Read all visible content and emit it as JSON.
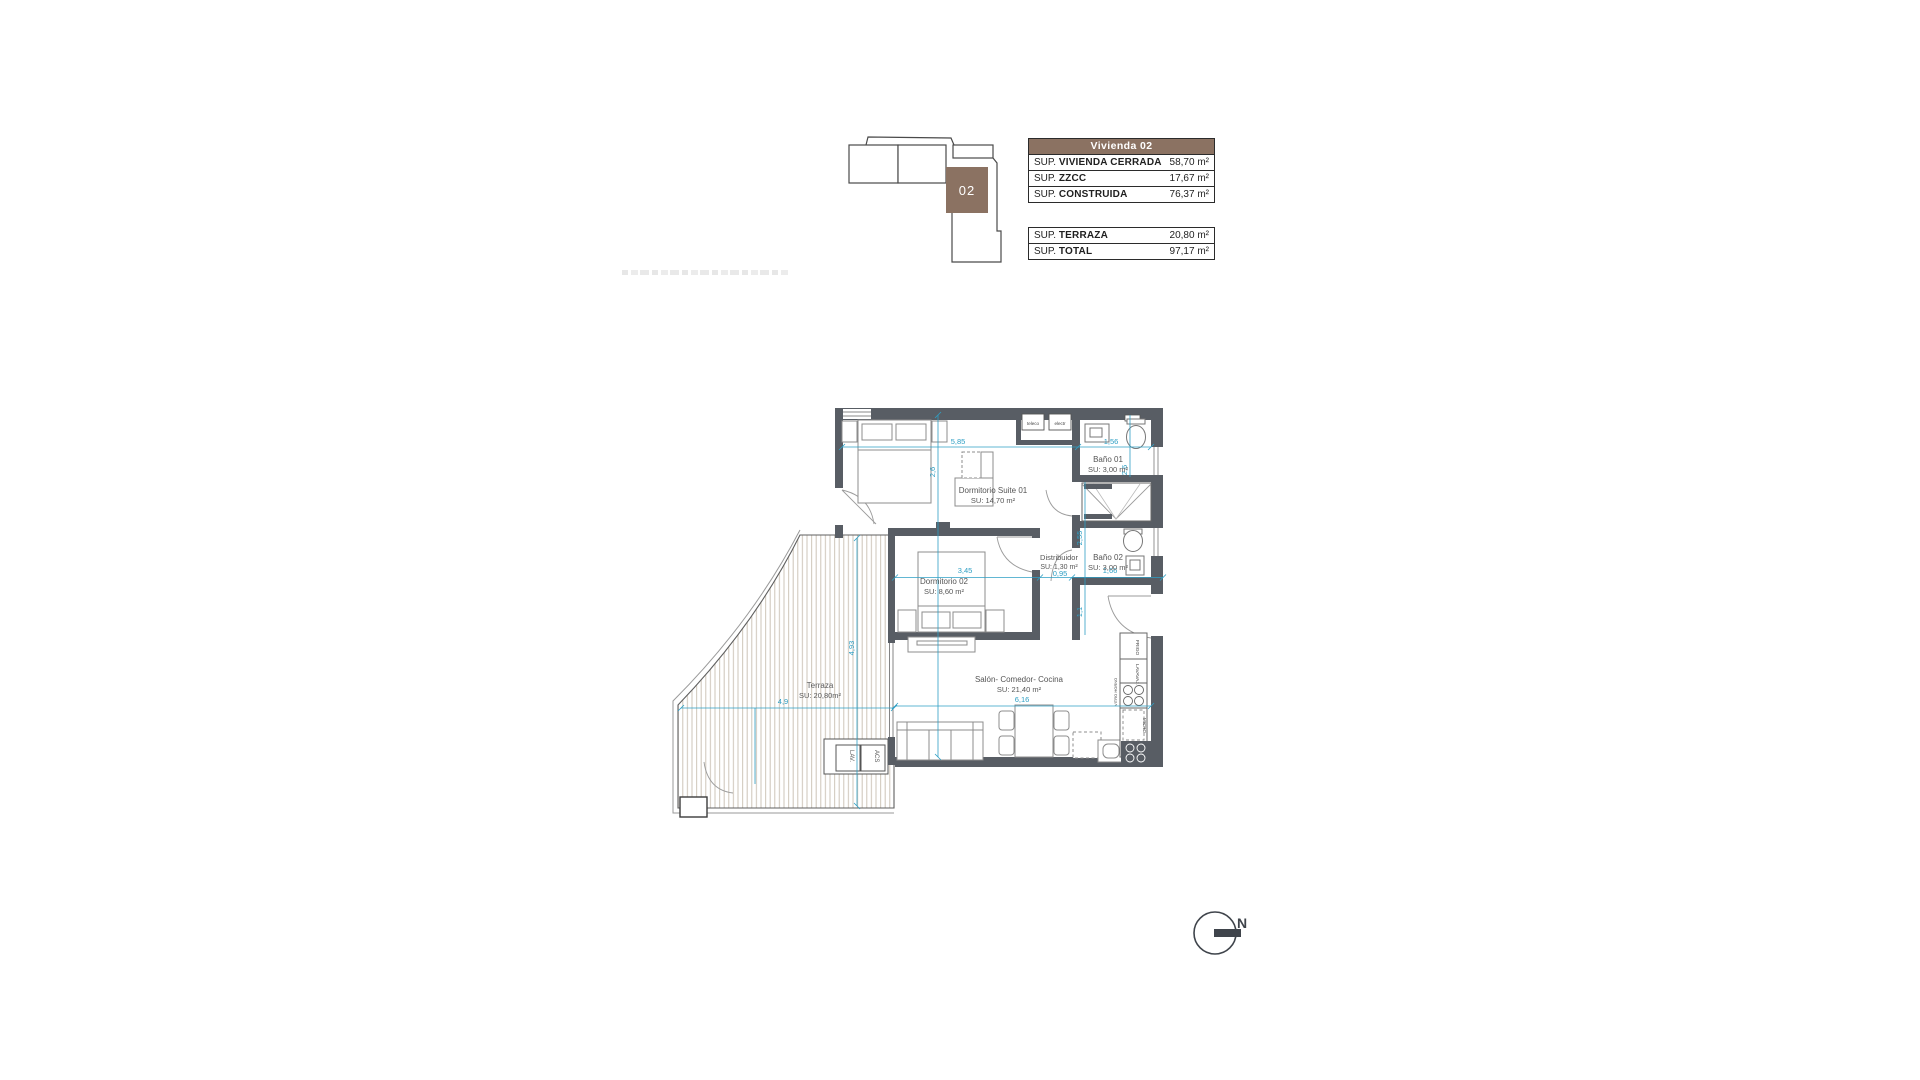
{
  "key_plan": {
    "unit_label": "02",
    "accent_color": "#8b7262"
  },
  "tables": {
    "unit_suffix": "m²",
    "main": {
      "header": "Vivienda 02",
      "rows": [
        {
          "prefix": "SUP.",
          "name": "VIVIENDA CERRADA",
          "value": "58,70 m²"
        },
        {
          "prefix": "SUP.",
          "name": "ZZCC",
          "value": "17,67 m²"
        },
        {
          "prefix": "SUP.",
          "name": "CONSTRUIDA",
          "value": "76,37 m²"
        }
      ]
    },
    "secondary": {
      "rows": [
        {
          "prefix": "SUP.",
          "name": "TERRAZA",
          "value": "20,80 m²"
        },
        {
          "prefix": "SUP.",
          "name": "TOTAL",
          "value": "97,17 m²"
        }
      ]
    }
  },
  "rooms": {
    "suite": {
      "name": "Dormitorio Suite  01",
      "area": "SU: 14,70 m²"
    },
    "bano1": {
      "name": "Baño 01",
      "area": "SU: 3,00 m²"
    },
    "bano2": {
      "name": "Baño 02",
      "area": "SU: 3,00 m²"
    },
    "distribuidor": {
      "name": "Distribuidor",
      "area": "SU: 1,30 m²"
    },
    "dorm2": {
      "name": "Dormitorio 02",
      "area": "SU: 8,60 m²"
    },
    "salon": {
      "name": "Salón- Comedor- Cocina",
      "area": "SU: 21,40 m²"
    },
    "terraza": {
      "name": "Terraza",
      "area": "SU: 20,80m²"
    }
  },
  "dimensions": {
    "suite_w": "5,85",
    "bano1_w": "1,56",
    "suite_h": "2,6",
    "bano1_h": "2,6",
    "dorm2_w": "3,45",
    "distrib_w": "0,95",
    "bano2_w": "1,66",
    "pass_h": "2,55",
    "entry_h": "1,1",
    "salon_w": "6,16",
    "terraza_h": "4,93",
    "terraza_w": "4,9"
  },
  "fixtures": {
    "teleco": "teleco",
    "electr": "electr",
    "frigo": "FRIGO",
    "lavavaj": "LAVAVAJ.",
    "vitro": "VITRO HORNO",
    "micro": "MICRO",
    "lav": "LAV.",
    "acs": "ACS"
  },
  "compass": {
    "north": "N"
  },
  "colors": {
    "wall": "#585d64",
    "dim": "#2e9fc4",
    "accent": "#8b7262"
  }
}
